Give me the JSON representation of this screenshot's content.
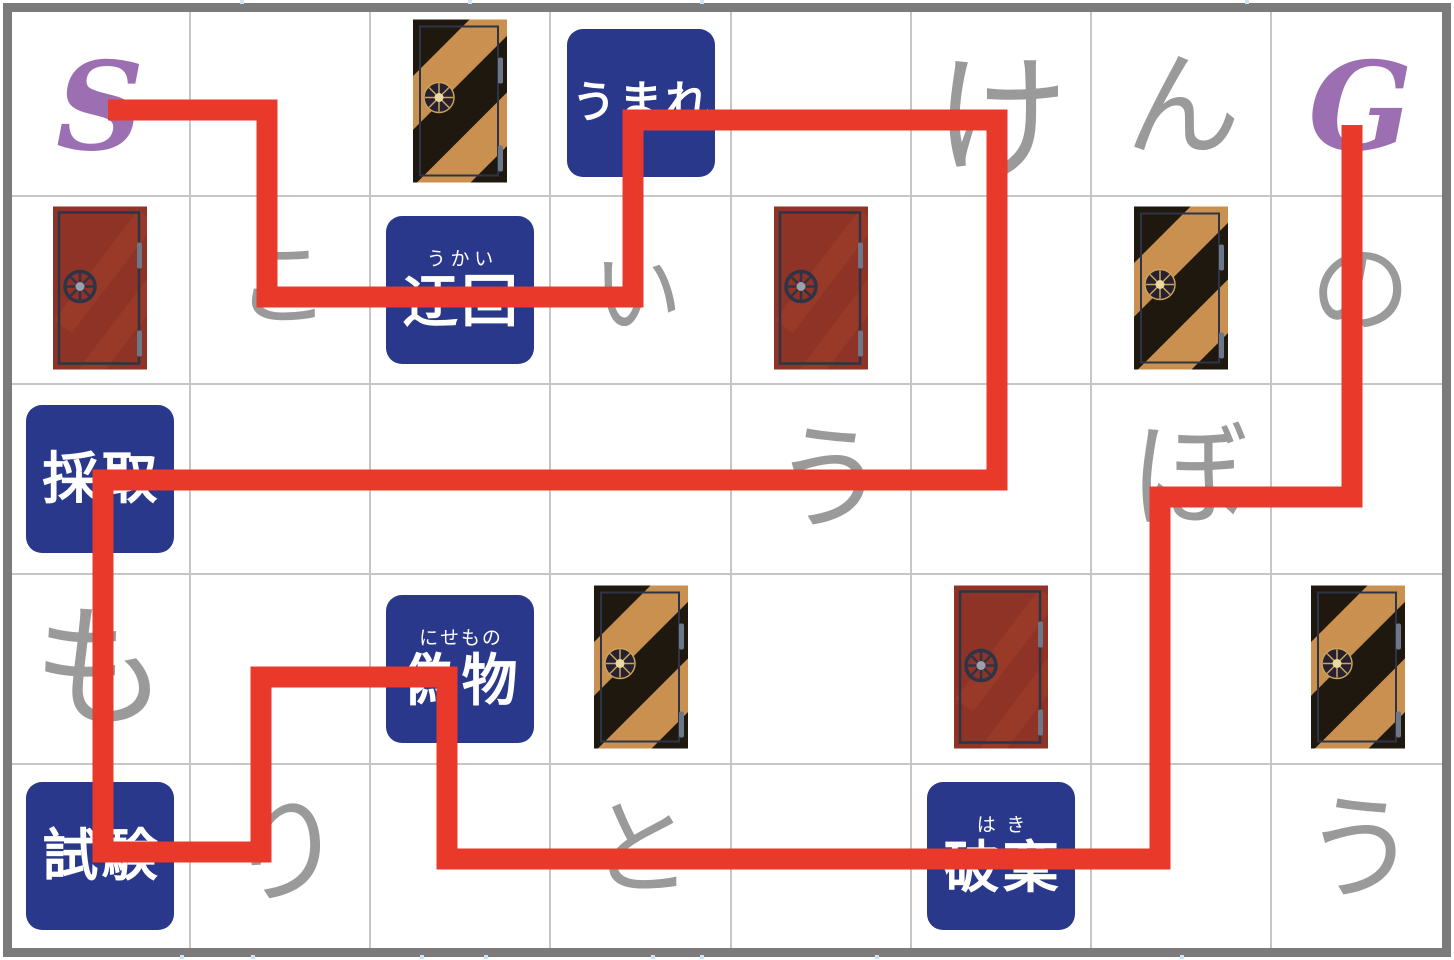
{
  "board": {
    "width": 1454,
    "height": 960,
    "col_bounds": [
      10,
      190,
      370,
      550,
      731,
      911,
      1091,
      1271,
      1444
    ],
    "row_bounds": [
      10,
      196,
      384,
      574,
      764,
      948
    ],
    "border_color": "#7b7b7b",
    "grid_color": "#c6c6c6",
    "background": "#ffffff",
    "tick_color": "#cfe2f4",
    "ticks_top_x": [
      240,
      468,
      700,
      1245
    ],
    "ticks_bottom_x": [
      180,
      251,
      420,
      484,
      651,
      700,
      875,
      1180
    ]
  },
  "colors": {
    "path_red": "#E8392B",
    "marker_purple": "#9B6FB2",
    "hint_gray": "#9A9A9A",
    "square_blue": "#2A388C",
    "square_text": "#FFFFFF",
    "door_red_body": "#8E3325",
    "door_red_streak": "#A23E2C",
    "door_frame": "#2D3447",
    "door_hinge": "#6E7788",
    "door_knob_gray": "#9AA0AC",
    "door_tan": "#C99050",
    "door_stripe_black": "#1E180F",
    "door_wheel_gold": "#C9A45A",
    "door_wheel_cream": "#EAD9A0",
    "door_wheel_dark": "#262030"
  },
  "markers": {
    "start": {
      "label": "S",
      "col": 1,
      "row": 1,
      "dx": 0,
      "dy": 6
    },
    "goal": {
      "label": "G",
      "col": 8,
      "row": 1,
      "dx": 3,
      "dy": 6
    }
  },
  "hint_letters": [
    {
      "char": "け",
      "romaji": "ke",
      "col": 6,
      "row": 1,
      "size": 135,
      "dx": 0,
      "dy": 16
    },
    {
      "char": "ん",
      "romaji": "n",
      "col": 7,
      "row": 1,
      "size": 115,
      "dx": 2,
      "dy": 4
    },
    {
      "char": "こ",
      "romaji": "ko",
      "col": 2,
      "row": 2,
      "size": 95,
      "dx": 3,
      "dy": -4
    },
    {
      "char": "い",
      "romaji": "i",
      "col": 4,
      "row": 2,
      "size": 90,
      "dx": -3,
      "dy": 5
    },
    {
      "char": "の",
      "romaji": "no",
      "col": 8,
      "row": 2,
      "size": 100,
      "dx": 3,
      "dy": 0
    },
    {
      "char": "う",
      "romaji": "u",
      "col": 5,
      "row": 3,
      "size": 115,
      "dx": 9,
      "dy": 1
    },
    {
      "char": "ぼ",
      "romaji": "bo",
      "col": 7,
      "row": 3,
      "size": 115,
      "dx": 9,
      "dy": -2
    },
    {
      "char": "も",
      "romaji": "mo",
      "col": 1,
      "row": 4,
      "size": 135,
      "dx": 0,
      "dy": 0
    },
    {
      "char": "り",
      "romaji": "ri",
      "col": 2,
      "row": 5,
      "size": 120,
      "dx": 5,
      "dy": -4
    },
    {
      "char": "と",
      "romaji": "to",
      "col": 4,
      "row": 5,
      "size": 105,
      "dx": 0,
      "dy": -6
    },
    {
      "char": "う",
      "romaji": "u",
      "col": 8,
      "row": 5,
      "size": 115,
      "dx": 3,
      "dy": -6
    }
  ],
  "word_squares": [
    {
      "word": "うまれ",
      "furigana": "",
      "romaji": "umare",
      "col": 4,
      "row": 1,
      "text_size": 44
    },
    {
      "word": "迂回",
      "furigana": "うかい",
      "romaji": "ukai",
      "col": 3,
      "row": 2,
      "text_size": 56
    },
    {
      "word": "採取",
      "furigana": "",
      "romaji": "saishu",
      "col": 1,
      "row": 3,
      "text_size": 56
    },
    {
      "word": "偽物",
      "furigana": "にせもの",
      "romaji": "nisemono",
      "col": 3,
      "row": 4,
      "text_size": 56
    },
    {
      "word": "試験",
      "furigana": "",
      "romaji": "shiken",
      "col": 1,
      "row": 5,
      "text_size": 56
    },
    {
      "word": "破棄",
      "furigana": "はき",
      "romaji": "haki",
      "col": 6,
      "row": 5,
      "text_size": 56
    }
  ],
  "doors": [
    {
      "type": "striped",
      "col": 3,
      "row": 1
    },
    {
      "type": "red",
      "col": 1,
      "row": 2
    },
    {
      "type": "red",
      "col": 5,
      "row": 2
    },
    {
      "type": "striped",
      "col": 7,
      "row": 2
    },
    {
      "type": "striped",
      "col": 4,
      "row": 4
    },
    {
      "type": "red",
      "col": 6,
      "row": 4
    },
    {
      "type": "striped",
      "col": 8,
      "row": 4
    }
  ],
  "path": {
    "thickness": 21,
    "points": [
      [
        108,
        110
      ],
      [
        267,
        110
      ],
      [
        267,
        297
      ],
      [
        633,
        297
      ],
      [
        633,
        120
      ],
      [
        997,
        120
      ],
      [
        997,
        480
      ],
      [
        103,
        480
      ],
      [
        103,
        852
      ],
      [
        261,
        852
      ],
      [
        261,
        677
      ],
      [
        447,
        677
      ],
      [
        447,
        859
      ],
      [
        1160,
        859
      ],
      [
        1160,
        497
      ],
      [
        1352,
        497
      ],
      [
        1352,
        125
      ]
    ]
  }
}
